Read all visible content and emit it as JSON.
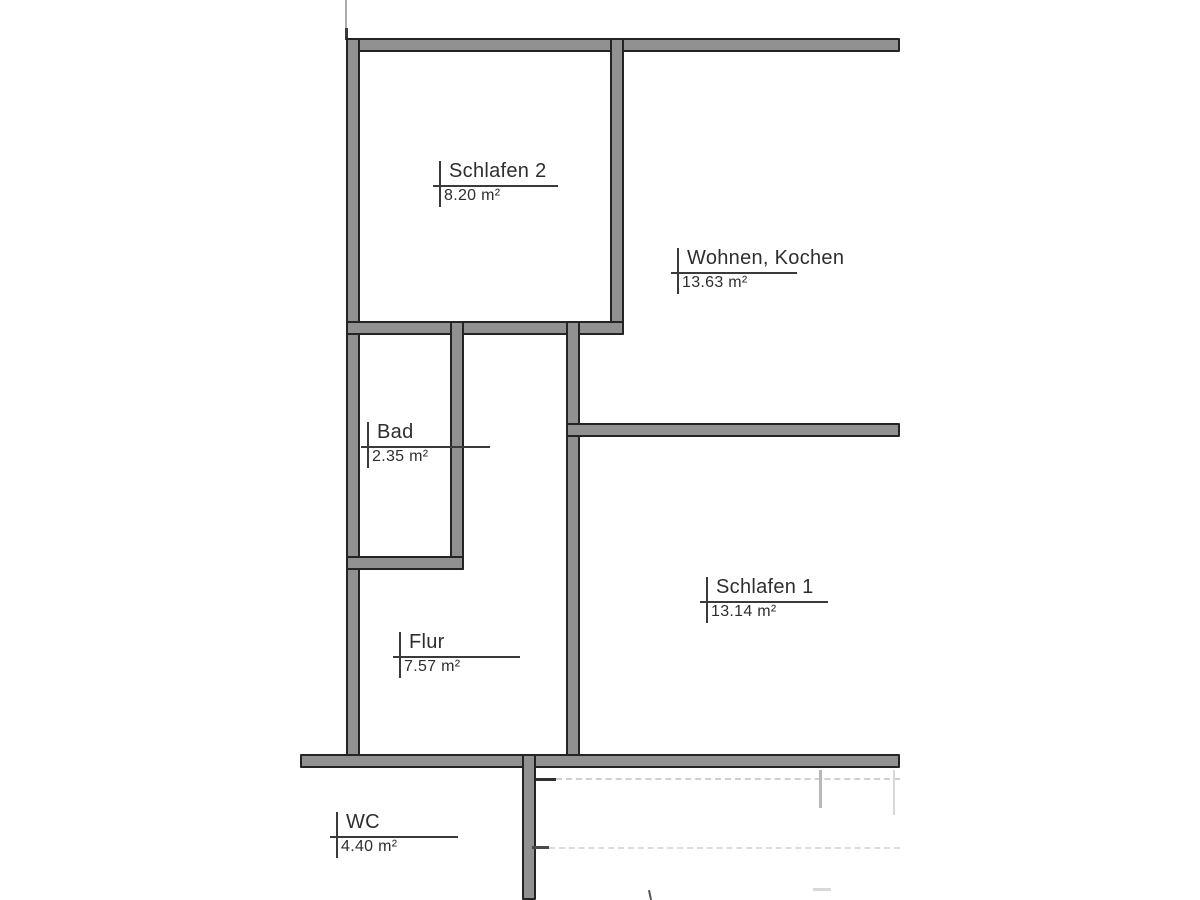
{
  "floorplan": {
    "rooms": [
      {
        "name": "Schlafen 2",
        "area": "8.20 m²"
      },
      {
        "name": "Wohnen, Kochen",
        "area": "13.63 m²"
      },
      {
        "name": "Bad",
        "area": "2.35 m²"
      },
      {
        "name": "Schlafen 1",
        "area": "13.14 m²"
      },
      {
        "name": "Flur",
        "area": "7.57 m²"
      },
      {
        "name": "WC",
        "area": "4.40 m²"
      }
    ],
    "colors": {
      "wall_fill": "#919191",
      "wall_edge": "#242424",
      "label_line": "#3a3a3a",
      "label_text": "#2e2e2e",
      "background": "#ffffff",
      "faint_line": "#cfcfcf"
    }
  }
}
